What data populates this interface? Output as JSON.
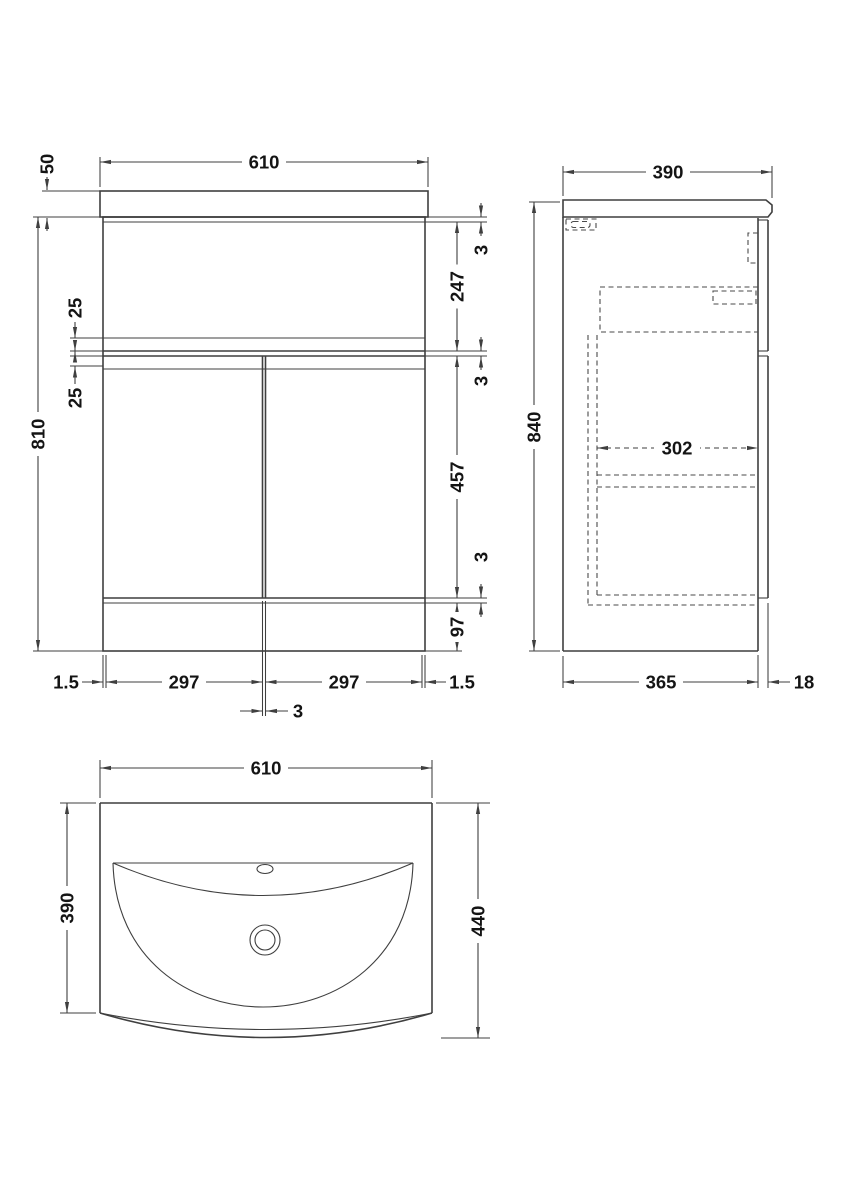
{
  "dims": {
    "front": {
      "width": "610",
      "worktop_height": "50",
      "cabinet_height": "810",
      "rail_upper": "25",
      "rail_lower": "25",
      "top_gap": "3",
      "drawer_height": "247",
      "mid_gap": "3",
      "door_height": "457",
      "bottom_gap": "3",
      "plinth_height": "97",
      "left_margin": "1.5",
      "door_left": "297",
      "door_gap": "3",
      "door_right": "297",
      "right_margin": "1.5"
    },
    "side": {
      "depth": "390",
      "height": "840",
      "internal_depth": "302",
      "carcass_depth": "365",
      "door_thickness": "18"
    },
    "plan": {
      "width": "610",
      "basin_depth": "390",
      "overall_depth": "440"
    }
  },
  "colors": {
    "line": "#3f3f3f",
    "text": "#141414",
    "background": "#ffffff"
  }
}
